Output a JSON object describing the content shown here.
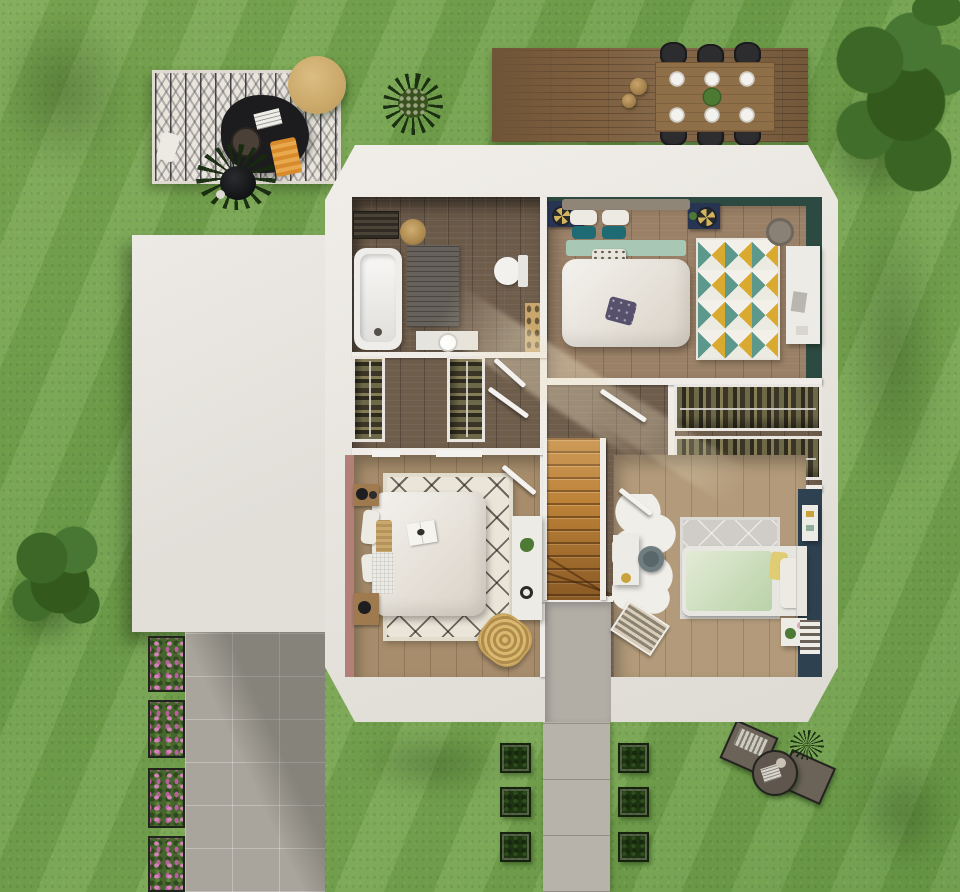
{
  "scene": {
    "label": "3D rendered top-down floor plan of a house upper floor with garden",
    "view": "top-down render, no visible text",
    "palette": {
      "grass": "#74a24c",
      "roof_white": "#ece9e4",
      "deck_wood": "#7d5f3e",
      "hallway_floor": "#6f5d4b",
      "bedroom_floor": "#9a8066",
      "stair_wood": "#bd8238",
      "green_accent_wall": "#2c4a41",
      "pink_accent_wall": "#b28077",
      "teal_accent_wall": "#2e4150",
      "paving": "#a9a59c",
      "flower_pink": "#cf7fb5",
      "rug_yellow": "#d9a930",
      "rug_teal": "#5d988c"
    },
    "garden": {
      "lounge_corner": {
        "label": "Outdoor lounge rug with black coffee table, round pouf, orange throw and potted plant"
      },
      "terrace": {
        "label": "Wooden terrace with dining table",
        "chairs": 6,
        "plates": 6,
        "items": [
          "centerpiece plant",
          "two clay vases"
        ]
      },
      "trees": {
        "count": 2,
        "positions": [
          "top-right",
          "left-middle"
        ]
      },
      "shrub": {
        "label": "Round shrub near terrace"
      },
      "hedge_planters": {
        "count": 6,
        "layout": "two columns of three flanking the garden path"
      },
      "flower_boxes": {
        "count": 4,
        "label": "Pink flower boxes along driveway"
      },
      "driveway": {
        "label": "Paved driveway below garage roof"
      },
      "walkway": {
        "label": "Concrete garden path from entrance"
      },
      "bistro_set": {
        "label": "Two garden loungers with round side table and small plant",
        "chairs": 2
      }
    },
    "house": {
      "label": "Upper floor plan with white cut roof band",
      "garage_roof": {
        "label": "Flat white garage roof"
      },
      "rooms": [
        {
          "id": "bathroom",
          "label": "Bathroom",
          "furniture": [
            "bathtub",
            "toilet",
            "wooden shelf",
            "washbasin",
            "bath mat",
            "towel radiator",
            "wall basket"
          ]
        },
        {
          "id": "master-bedroom",
          "label": "Master bedroom",
          "furniture": [
            "double bed",
            "2 navy nightstands",
            "geometric triangle rug",
            "white dresser",
            "laundry basket"
          ]
        },
        {
          "id": "hallway",
          "label": "Hallway and landing",
          "furniture": [
            "2 wardrobes with hanging clothes",
            "wooden staircase",
            "open white doors"
          ]
        },
        {
          "id": "walk-in-closet",
          "label": "Walk-in closet",
          "furniture": [
            "2 horizontal clothes racks"
          ]
        },
        {
          "id": "bedroom-2",
          "label": "Second bedroom",
          "furniture": [
            "double bed",
            "berber diamond rug",
            "white desk",
            "rattan chair",
            "2 wooden nightstands"
          ]
        },
        {
          "id": "kids-bedroom",
          "label": "Kids bedroom",
          "furniture": [
            "single bed with green mattress",
            "cloud rug",
            "desk and chair",
            "nightstand with plant",
            "radiator"
          ]
        }
      ]
    }
  }
}
